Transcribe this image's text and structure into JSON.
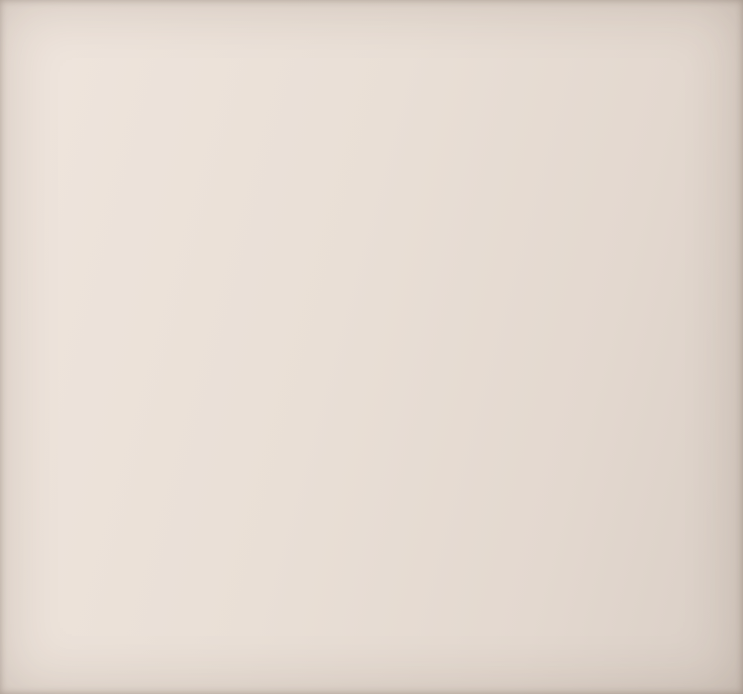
{
  "colors": {
    "wall_fill": "#d9b7b3",
    "room_number_red": "#a8352c",
    "height_note_blue": "#4a4aa0"
  },
  "plan": {
    "note": "Н-3,20",
    "rooms": {
      "r5": {
        "num": "-5",
        "area": "6,5"
      },
      "r6": {
        "num": "-6",
        "area": "5,1"
      },
      "r7": {
        "num": "-7",
        "area": "14,6"
      },
      "r8": {
        "num": "-8",
        "area": "12,9"
      },
      "r9": {
        "num": "-9",
        "area": "21,9"
      },
      "r10": {
        "num": "-10",
        "area": "3,5"
      },
      "r11": {
        "num": "-11",
        "area": "7,6"
      },
      "r12": {
        "num": "-12",
        "area": "23,8"
      }
    },
    "dims": {
      "top_overall": "10,30",
      "left_overall": "10,58",
      "r9_w": "6,55",
      "r9_h": "3,35",
      "r10_w": "2,20",
      "r10_h": "1,57",
      "ne_h": "2,49",
      "r11_w": "2,12",
      "r11_h": "1,66",
      "n080": "0,80",
      "n025": "0,25",
      "n035": "0,35",
      "n094": "0,94",
      "n230": "2,30",
      "n060": "0,60",
      "corridor_h": "4,38",
      "r8_w": "4,64",
      "r8_h": "2,78",
      "r7_w": "4,82",
      "r7_h": "2,78",
      "r7_bottom": "6,12",
      "bottom_left": "7,30",
      "n161": "1,61",
      "n121": "1,21",
      "n138": "1,38",
      "n150": "1,50",
      "n117": "1,17",
      "r6_w": "2,82",
      "r6_h": "1,82",
      "step_h": "0,90",
      "bottom_right": "6,87",
      "r12_top_outer": "4,06",
      "r12_w": "3,70",
      "r12_h_inner": "6,44",
      "r12_h_outer": "7,20"
    }
  }
}
